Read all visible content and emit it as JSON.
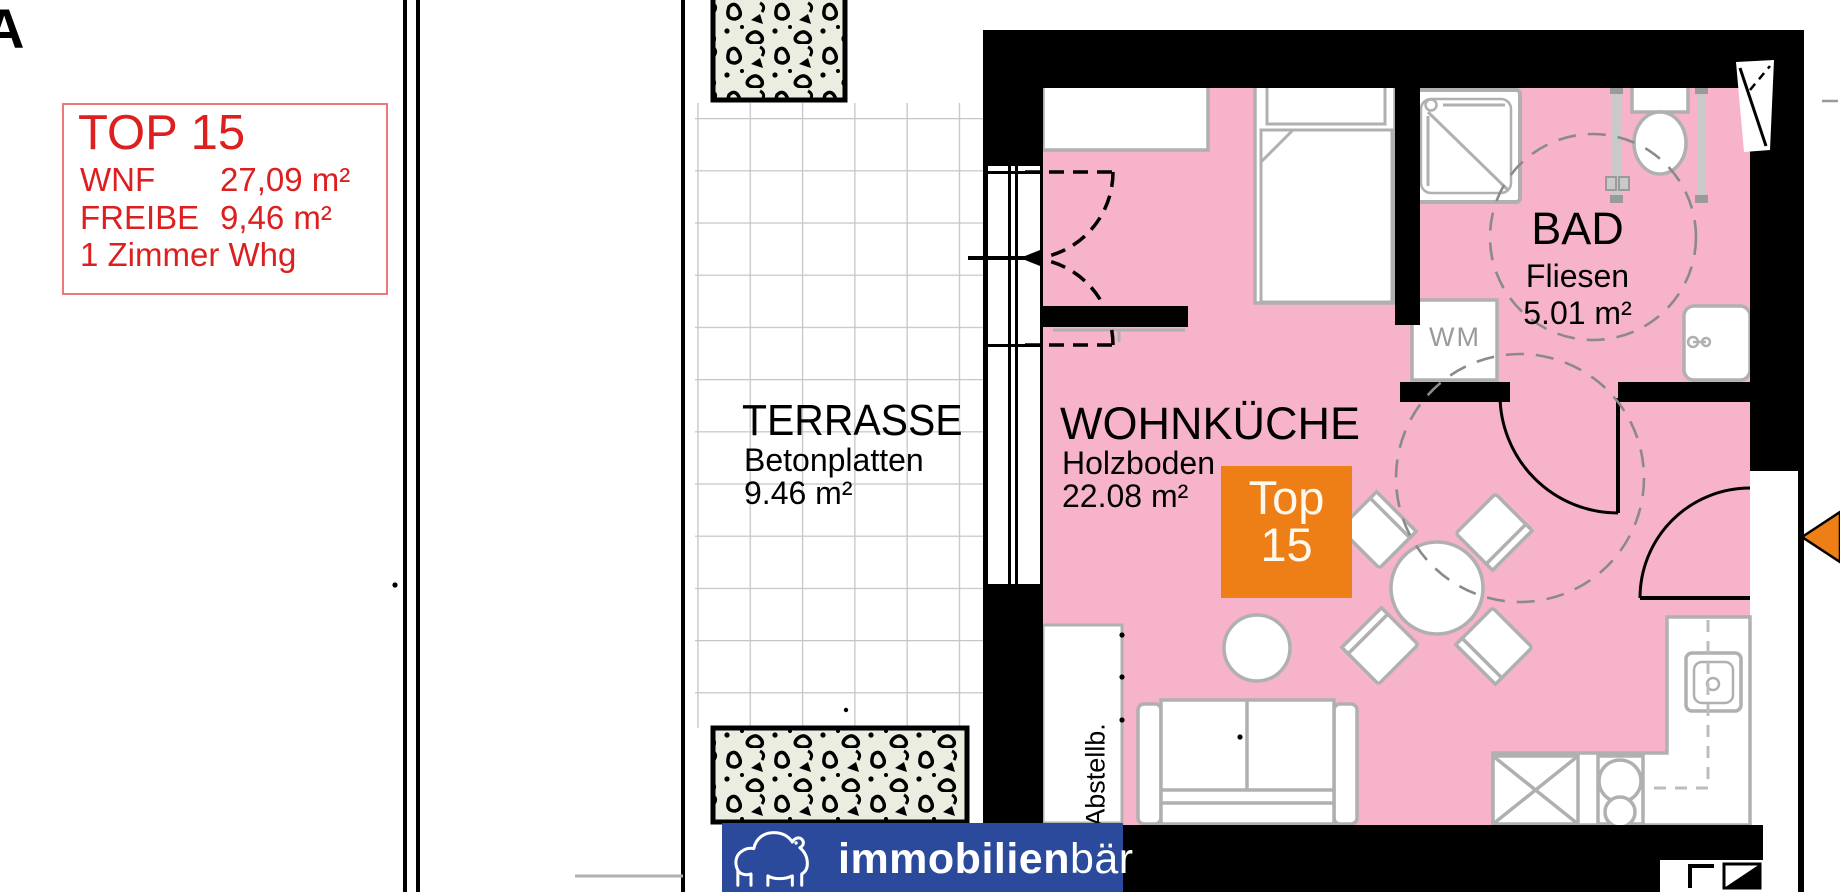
{
  "meta": {
    "corner_letter": "A"
  },
  "info_box": {
    "title": "TOP 15",
    "rows": [
      {
        "label": "WNF",
        "value": "27,09 m²"
      },
      {
        "label": "FREIBE",
        "value": "9,46 m²"
      }
    ],
    "type_line": "1 Zimmer Whg"
  },
  "rooms": {
    "terrace": {
      "name": "TERRASSE",
      "floor": "Betonplatten",
      "area": "9.46 m²"
    },
    "living": {
      "name": "WOHNKÜCHE",
      "floor": "Holzboden",
      "area": "22.08 m²"
    },
    "bath": {
      "name": "BAD",
      "floor": "Fliesen",
      "area": "5.01 m²"
    },
    "storage": {
      "abbrev": "Abstellb."
    },
    "washing_machine": {
      "label": "WM"
    }
  },
  "badge": {
    "line1": "Top",
    "line2": "15"
  },
  "logo": {
    "bold": "immobilien",
    "light": "bär"
  },
  "colors": {
    "pink": "#F7B3CA",
    "orange": "#EE7E16",
    "banner_blue": "#2B4A9B",
    "red": "#DC1F1F",
    "hedge_green": "#EAEDE0"
  }
}
